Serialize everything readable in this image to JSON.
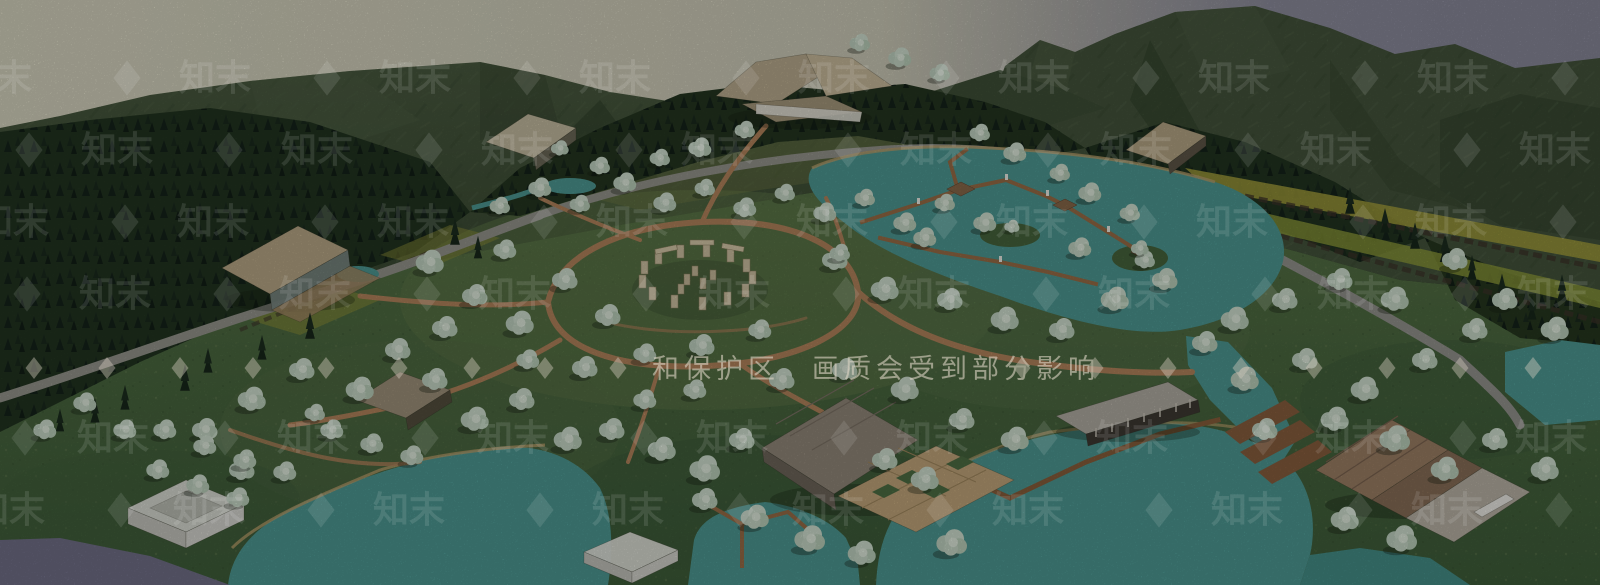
{
  "meta": {
    "title": "Aerial 3D rendering of a mountain lake resort masterplan",
    "style": "textured low-poly model render, bird's-eye view"
  },
  "watermarks": {
    "tile_text": "知末",
    "notice_text": "和保护区　画质会受到部分影响",
    "diamond_glyph": "◆"
  },
  "palette": {
    "sky_left": "#d9d7c2",
    "sky_right": "#8d8d9e",
    "mountain": "#42523a",
    "forest": "#1d2b1e",
    "meadow": "#4e6b41",
    "water": "#4f9b95",
    "water_shadow": "#72718a",
    "path": "#b5855d",
    "road": "#96968e",
    "terrace": "#a3a03c",
    "roof_tan": "#bcae90",
    "stone": "#d0c3a3",
    "tree_foliage": "#cfe0d1",
    "pier": "#9a6e47"
  },
  "landmarks": {
    "stone_circle": "stone circle at meadow center",
    "main_lodge": "large lodge at top center",
    "left_lodge": "hillside lodge on the left",
    "lake_piers": "zigzag timber boardwalks with huts on east lake",
    "pavilion": "large roofed pavilion with plaza at bottom center",
    "gallery": "long row building right of center",
    "waterfront_complex": "terraced waterfront buildings bottom right",
    "glass_box": "translucent white box pavilion bottom left"
  }
}
